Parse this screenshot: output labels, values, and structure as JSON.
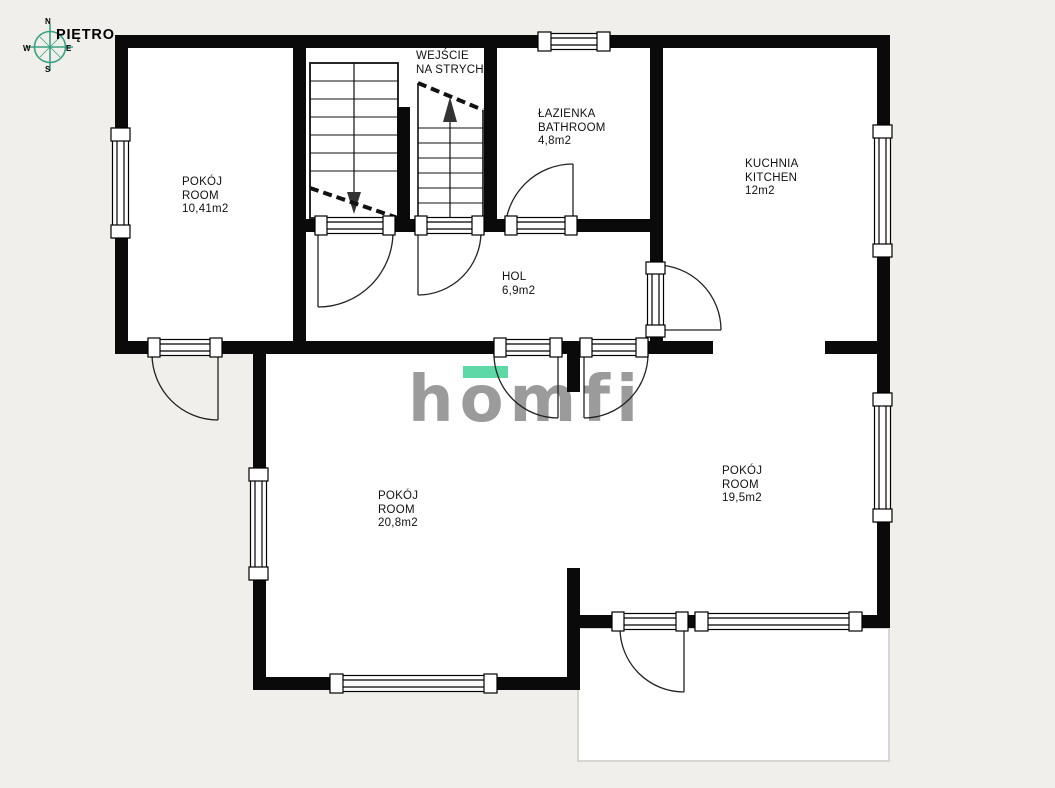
{
  "title": "PIĘTRO",
  "compass": {
    "n": "N",
    "e": "E",
    "s": "S",
    "w": "W"
  },
  "watermark": {
    "text": "homfi"
  },
  "colors": {
    "background": "#f0efeb",
    "floor": "#ffffff",
    "walls": "#0a0a0a",
    "compass_green": "#3ba183",
    "logo_gray": "#9b9b9b",
    "logo_mint": "#5ed9a5",
    "balcony_border": "#d8d6d1"
  },
  "rooms": [
    {
      "id": "room-upper-left",
      "lines": [
        "POKÓJ",
        "ROOM",
        "10,41m2"
      ]
    },
    {
      "id": "attic-entrance",
      "lines": [
        "WEJŚCIE",
        "NA STRYCH"
      ]
    },
    {
      "id": "bathroom",
      "lines": [
        "ŁAZIENKA",
        "BATHROOM",
        "4,8m2"
      ]
    },
    {
      "id": "kitchen",
      "lines": [
        "KUCHNIA",
        "KITCHEN",
        "12m2"
      ]
    },
    {
      "id": "hall",
      "lines": [
        "HOL",
        "6,9m2"
      ]
    },
    {
      "id": "room-lower-left",
      "lines": [
        "POKÓJ",
        "ROOM",
        "20,8m2"
      ]
    },
    {
      "id": "room-lower-right",
      "lines": [
        "POKÓJ",
        "ROOM",
        "19,5m2"
      ]
    }
  ]
}
